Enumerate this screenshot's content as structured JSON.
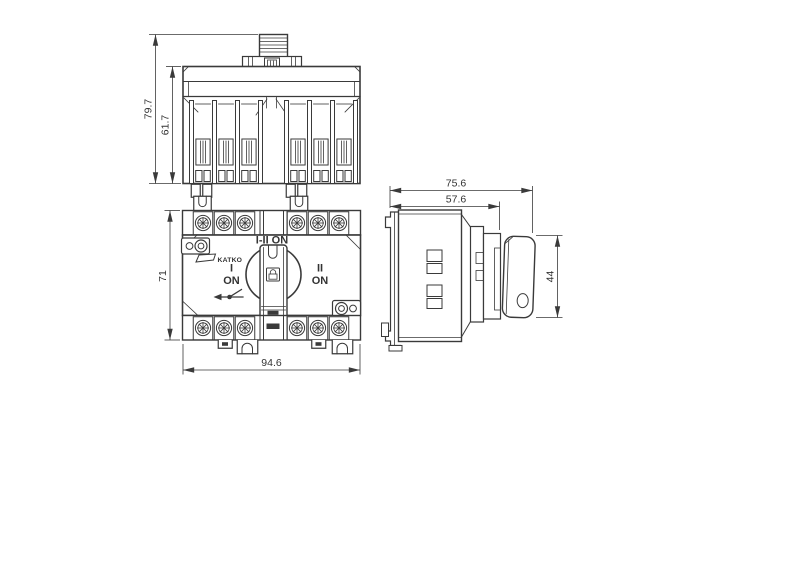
{
  "drawing": {
    "background_color": "#ffffff",
    "line_color": "#3a3a3a",
    "views": {
      "top": {
        "overall_height": "79.7",
        "body_height": "61.7"
      },
      "front": {
        "height": "71",
        "width": "94.6",
        "labels": {
          "center_position": "I-II ON",
          "left_position_line1": "I",
          "left_position_line2": "ON",
          "right_position_line1": "II",
          "right_position_line2": "ON",
          "brand": "KATKO"
        }
      },
      "side": {
        "depth_overall": "75.6",
        "depth_body": "57.6",
        "handle_height": "44"
      }
    },
    "icons": {
      "knob_center": "padlock-icon",
      "left_direction": "switch-lever-icon",
      "brand_mark": "brand-flag-icon"
    }
  }
}
